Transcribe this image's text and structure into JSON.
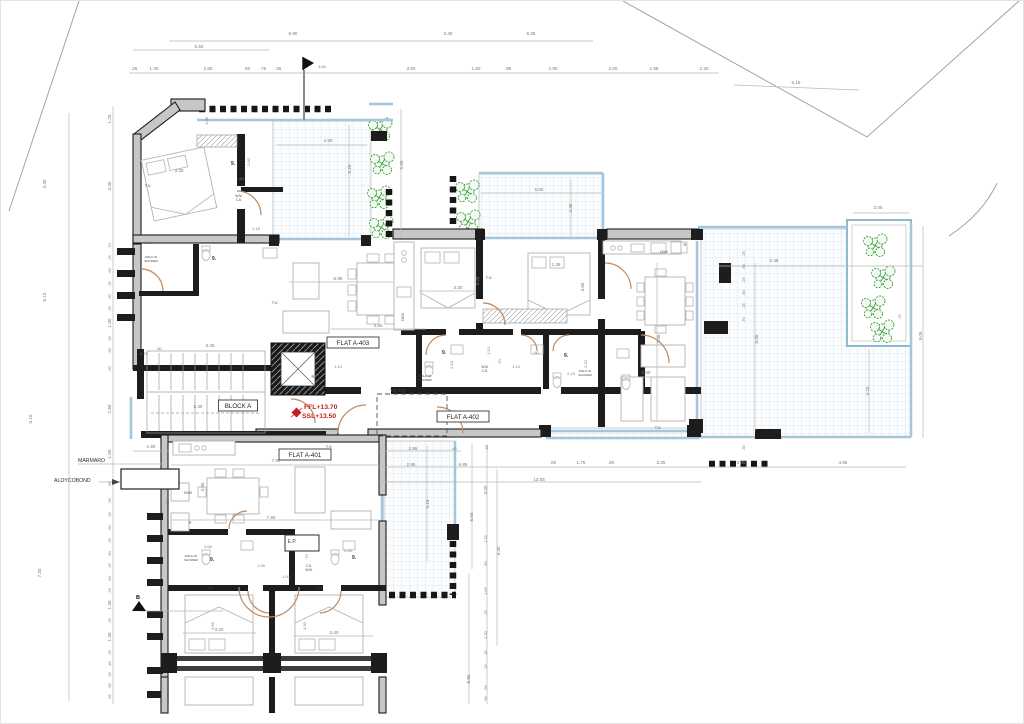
{
  "palette": {
    "wall": "#1d1d1d",
    "dim_text": "#7a7a7a",
    "label_text": "#474747",
    "red": "#c42020",
    "glass": "#a5c6dc",
    "plant": "#3d9c3d",
    "door": "#c08a5f",
    "box_stroke": "#3a3a3a"
  },
  "plan": {
    "boxed_labels": [
      {
        "text": "FLAT A-403",
        "x": 352,
        "y": 344
      },
      {
        "text": "FLAT A-402",
        "x": 462,
        "y": 418
      },
      {
        "text": "FLAT A-401",
        "x": 304,
        "y": 456
      },
      {
        "text": "BLOCK A",
        "x": 237,
        "y": 407
      }
    ],
    "red_annotations": [
      {
        "text": "FFL+13.70",
        "x": 303,
        "y": 408
      },
      {
        "text": "SSL+13.50",
        "x": 301,
        "y": 417
      }
    ],
    "material_labels": [
      {
        "text": "MARMARO",
        "x": 77,
        "y": 461
      },
      {
        "text": "ALOYCOBOND",
        "x": 53,
        "y": 481
      }
    ],
    "section_markers": [
      {
        "text": "B",
        "x": 137,
        "y": 598
      }
    ],
    "room_labels": [
      {
        "t": "9.",
        "x": 232,
        "y": 164,
        "s": 5.5
      },
      {
        "t": "9.",
        "x": 213,
        "y": 259,
        "s": 5.5
      },
      {
        "t": "9.",
        "x": 443,
        "y": 353,
        "s": 5.5
      },
      {
        "t": "9.",
        "x": 565,
        "y": 356,
        "s": 5.5
      },
      {
        "t": "9.",
        "x": 211,
        "y": 560,
        "s": 5.5
      },
      {
        "t": "9.",
        "x": 353,
        "y": 558,
        "s": 5.5
      },
      {
        "t": "T.V.",
        "x": 147,
        "y": 186,
        "s": 4
      },
      {
        "t": "T.V.",
        "x": 274,
        "y": 303,
        "s": 4
      },
      {
        "t": "T.V.",
        "x": 488,
        "y": 278,
        "s": 4
      },
      {
        "t": "T.V.",
        "x": 328,
        "y": 447,
        "s": 4
      },
      {
        "t": "T.V.",
        "x": 210,
        "y": 588,
        "s": 4
      },
      {
        "t": "T.V.",
        "x": 318,
        "y": 588,
        "s": 4
      },
      {
        "t": "T.V.",
        "x": 657,
        "y": 428,
        "s": 4
      },
      {
        "t": "D/W",
        "x": 663,
        "y": 252,
        "s": 4
      },
      {
        "t": "D/W",
        "x": 187,
        "y": 493,
        "s": 4
      },
      {
        "t": "D/W",
        "x": 403,
        "y": 316,
        "s": 4,
        "r": 1
      },
      {
        "t": "R",
        "x": 684,
        "y": 245,
        "s": 4
      },
      {
        "t": "R",
        "x": 189,
        "y": 523,
        "s": 4
      },
      {
        "t": "R",
        "x": 312,
        "y": 377,
        "s": 4
      },
      {
        "t": "E.P.",
        "x": 291,
        "y": 542,
        "s": 5
      },
      {
        "t": "T.E.P.R.",
        "x": 397,
        "y": 391,
        "s": 4.5
      },
      {
        "t": "W.M.",
        "x": 238,
        "y": 196,
        "s": 3.2
      },
      {
        "t": "C.D.",
        "x": 238,
        "y": 200,
        "s": 3.2
      },
      {
        "t": "W.M.",
        "x": 484,
        "y": 367,
        "s": 3.2
      },
      {
        "t": "C.D.",
        "x": 484,
        "y": 371,
        "s": 3.2
      },
      {
        "t": "C.D.",
        "x": 308,
        "y": 566,
        "s": 3.2
      },
      {
        "t": "W.M.",
        "x": 308,
        "y": 570,
        "s": 3.2
      },
      {
        "t": "WALK-IN",
        "x": 150,
        "y": 257,
        "s": 3
      },
      {
        "t": "SHOWER",
        "x": 150,
        "y": 261,
        "s": 3
      },
      {
        "t": "WALK-IN",
        "x": 424,
        "y": 376,
        "s": 3
      },
      {
        "t": "SHOWER",
        "x": 424,
        "y": 380,
        "s": 3
      },
      {
        "t": "WALK-IN",
        "x": 584,
        "y": 371,
        "s": 3
      },
      {
        "t": "SHOWER",
        "x": 584,
        "y": 375,
        "s": 3
      },
      {
        "t": "WALK-IN",
        "x": 190,
        "y": 556,
        "s": 3
      },
      {
        "t": "SHOWER",
        "x": 190,
        "y": 560,
        "s": 3
      }
    ],
    "dim_texts": [
      {
        "t": "8.90",
        "x": 292,
        "y": 34
      },
      {
        "t": "2.40",
        "x": 447,
        "y": 34
      },
      {
        "t": "6.35",
        "x": 530,
        "y": 34
      },
      {
        "t": "5.50",
        "x": 198,
        "y": 47
      },
      {
        "t": ".25",
        "x": 133,
        "y": 69
      },
      {
        "t": "1.25",
        "x": 153,
        "y": 69
      },
      {
        "t": "2.65",
        "x": 207,
        "y": 69
      },
      {
        "t": ".60",
        "x": 246,
        "y": 69
      },
      {
        "t": ".75",
        "x": 262,
        "y": 69
      },
      {
        "t": ".35",
        "x": 277,
        "y": 69
      },
      {
        "t": "3.60",
        "x": 321,
        "y": 67,
        "s": 4
      },
      {
        "t": "3.80",
        "x": 410,
        "y": 69
      },
      {
        "t": "1.60",
        "x": 475,
        "y": 69
      },
      {
        "t": ".95",
        "x": 507,
        "y": 69
      },
      {
        "t": "2.90",
        "x": 552,
        "y": 69
      },
      {
        "t": "2.00",
        "x": 612,
        "y": 69
      },
      {
        "t": "1.69",
        "x": 653,
        "y": 69
      },
      {
        "t": "2.20",
        "x": 703,
        "y": 69
      },
      {
        "t": "5.15",
        "x": 795,
        "y": 83
      },
      {
        "t": "4.40",
        "x": 45,
        "y": 183,
        "r": 1
      },
      {
        "t": "5.10",
        "x": 45,
        "y": 296,
        "r": 1
      },
      {
        "t": "5.10",
        "x": 31,
        "y": 418,
        "r": 1
      },
      {
        "t": "7.30",
        "x": 40,
        "y": 572,
        "r": 1
      },
      {
        "t": "1.25",
        "x": 110,
        "y": 118,
        "r": 1
      },
      {
        "t": "4.40",
        "x": 110,
        "y": 185,
        "r": 1
      },
      {
        "t": ".70",
        "x": 110,
        "y": 245,
        "r": 1,
        "s": 4
      },
      {
        "t": ".25",
        "x": 110,
        "y": 257,
        "r": 1,
        "s": 4
      },
      {
        "t": ".60",
        "x": 110,
        "y": 270,
        "r": 1,
        "s": 4
      },
      {
        "t": ".25",
        "x": 110,
        "y": 283,
        "r": 1,
        "s": 4
      },
      {
        "t": ".60",
        "x": 110,
        "y": 296,
        "r": 1,
        "s": 4
      },
      {
        "t": ".25",
        "x": 110,
        "y": 308,
        "r": 1,
        "s": 4
      },
      {
        "t": "1.30",
        "x": 110,
        "y": 322,
        "r": 1
      },
      {
        "t": ".25",
        "x": 110,
        "y": 338,
        "r": 1,
        "s": 4
      },
      {
        "t": ".90",
        "x": 110,
        "y": 350,
        "r": 1,
        "s": 4
      },
      {
        "t": ".50",
        "x": 110,
        "y": 368,
        "r": 1,
        "s": 4
      },
      {
        "t": "2.60",
        "x": 110,
        "y": 408,
        "r": 1
      },
      {
        "t": "1.50",
        "x": 110,
        "y": 453,
        "r": 1
      },
      {
        "t": ".50",
        "x": 110,
        "y": 483,
        "r": 1,
        "s": 4
      },
      {
        "t": ".95",
        "x": 110,
        "y": 500,
        "r": 1,
        "s": 4
      },
      {
        "t": ".25",
        "x": 110,
        "y": 514,
        "r": 1,
        "s": 4
      },
      {
        "t": ".60",
        "x": 110,
        "y": 527,
        "r": 1,
        "s": 4
      },
      {
        "t": ".25",
        "x": 110,
        "y": 540,
        "r": 1,
        "s": 4
      },
      {
        "t": ".60",
        "x": 110,
        "y": 553,
        "r": 1,
        "s": 4
      },
      {
        "t": ".25",
        "x": 110,
        "y": 565,
        "r": 1,
        "s": 4
      },
      {
        "t": ".60",
        "x": 110,
        "y": 578,
        "r": 1,
        "s": 4
      },
      {
        "t": ".25",
        "x": 110,
        "y": 590,
        "r": 1,
        "s": 4
      },
      {
        "t": "1.30",
        "x": 110,
        "y": 604,
        "r": 1
      },
      {
        "t": ".25",
        "x": 110,
        "y": 620,
        "r": 1,
        "s": 4
      },
      {
        "t": "1.30",
        "x": 110,
        "y": 636,
        "r": 1
      },
      {
        "t": ".25",
        "x": 110,
        "y": 652,
        "r": 1,
        "s": 4
      },
      {
        "t": ".45",
        "x": 110,
        "y": 663,
        "r": 1,
        "s": 4
      },
      {
        "t": ".25",
        "x": 110,
        "y": 674,
        "r": 1,
        "s": 4
      },
      {
        "t": ".55",
        "x": 110,
        "y": 685,
        "r": 1,
        "s": 4
      },
      {
        "t": ".55",
        "x": 110,
        "y": 696,
        "r": 1,
        "s": 4
      },
      {
        "t": "2.05",
        "x": 877,
        "y": 208
      },
      {
        "t": "9.05",
        "x": 921,
        "y": 335,
        "r": 1
      },
      {
        "t": "6.35",
        "x": 773,
        "y": 261
      },
      {
        "t": "8.05",
        "x": 757,
        "y": 338,
        "r": 1
      },
      {
        "t": ".75",
        "x": 900,
        "y": 316,
        "r": 1,
        "s": 4
      },
      {
        "t": "4.25",
        "x": 868,
        "y": 390,
        "r": 1
      },
      {
        "t": ".35",
        "x": 744,
        "y": 447,
        "r": 1,
        "s": 4
      },
      {
        "t": ".25",
        "x": 744,
        "y": 253,
        "r": 1,
        "s": 4
      },
      {
        "t": ".60",
        "x": 744,
        "y": 266,
        "r": 1,
        "s": 4
      },
      {
        "t": ".25",
        "x": 744,
        "y": 279,
        "r": 1,
        "s": 4
      },
      {
        "t": ".60",
        "x": 744,
        "y": 292,
        "r": 1,
        "s": 4
      },
      {
        "t": ".25",
        "x": 744,
        "y": 305,
        "r": 1,
        "s": 4
      },
      {
        "t": ".70",
        "x": 744,
        "y": 319,
        "r": 1,
        "s": 4
      },
      {
        "t": "2.95",
        "x": 412,
        "y": 449
      },
      {
        "t": ".40",
        "x": 453,
        "y": 449,
        "s": 4
      },
      {
        "t": ".45",
        "x": 487,
        "y": 447,
        "r": 1,
        "s": 4
      },
      {
        "t": "2.95",
        "x": 410,
        "y": 465
      },
      {
        "t": "6.85",
        "x": 462,
        "y": 465
      },
      {
        "t": ".60",
        "x": 552,
        "y": 463
      },
      {
        "t": "1.75",
        "x": 580,
        "y": 463
      },
      {
        "t": ".60",
        "x": 610,
        "y": 463
      },
      {
        "t": "3.25",
        "x": 660,
        "y": 463
      },
      {
        "t": "3.45",
        "x": 740,
        "y": 463
      },
      {
        "t": "4.95",
        "x": 842,
        "y": 463
      },
      {
        "t": "13.05",
        "x": 538,
        "y": 480
      },
      {
        "t": "5.10",
        "x": 428,
        "y": 503,
        "r": 1
      },
      {
        "t": "6.50",
        "x": 472,
        "y": 516,
        "r": 1
      },
      {
        "t": "3.00",
        "x": 486,
        "y": 489,
        "r": 1
      },
      {
        "t": "9.30",
        "x": 499,
        "y": 550,
        "r": 1
      },
      {
        "t": "1.35",
        "x": 486,
        "y": 538,
        "r": 1,
        "s": 4
      },
      {
        "t": ".60",
        "x": 486,
        "y": 563,
        "r": 1,
        "s": 4
      },
      {
        "t": "1.65",
        "x": 486,
        "y": 590,
        "r": 1,
        "s": 4
      },
      {
        "t": ".25",
        "x": 486,
        "y": 612,
        "r": 1,
        "s": 4
      },
      {
        "t": "1.30",
        "x": 486,
        "y": 634,
        "r": 1,
        "s": 4
      },
      {
        "t": ".45",
        "x": 486,
        "y": 652,
        "r": 1,
        "s": 4
      },
      {
        "t": ".25",
        "x": 486,
        "y": 666,
        "r": 1,
        "s": 4
      },
      {
        "t": "6.80",
        "x": 469,
        "y": 678,
        "r": 1
      },
      {
        "t": ".55",
        "x": 486,
        "y": 687,
        "r": 1,
        "s": 4
      },
      {
        "t": ".55",
        "x": 486,
        "y": 698,
        "r": 1,
        "s": 4
      },
      {
        "t": "1.00",
        "x": 207,
        "y": 120,
        "r": 1,
        "s": 4
      },
      {
        "t": "3.30",
        "x": 178,
        "y": 171
      },
      {
        "t": "1.30",
        "x": 148,
        "y": 243,
        "s": 4
      },
      {
        "t": "2.00",
        "x": 249,
        "y": 161,
        "r": 1,
        "s": 4
      },
      {
        "t": ".80",
        "x": 240,
        "y": 179,
        "s": 4
      },
      {
        "t": "1.15",
        "x": 255,
        "y": 229,
        "s": 4
      },
      {
        "t": "4.90",
        "x": 327,
        "y": 141
      },
      {
        "t": "5.25",
        "x": 350,
        "y": 168,
        "r": 1
      },
      {
        "t": "5.50",
        "x": 402,
        "y": 164,
        "r": 1
      },
      {
        "t": "5.00",
        "x": 538,
        "y": 190
      },
      {
        "t": "2.40",
        "x": 571,
        "y": 207,
        "r": 1
      },
      {
        "t": "5.95",
        "x": 337,
        "y": 279
      },
      {
        "t": "3.50",
        "x": 377,
        "y": 326
      },
      {
        "t": "3.30",
        "x": 457,
        "y": 288
      },
      {
        "t": "3.20",
        "x": 478,
        "y": 280,
        "r": 1
      },
      {
        "t": "1.35",
        "x": 555,
        "y": 265
      },
      {
        "t": "3.60",
        "x": 583,
        "y": 286,
        "r": 1
      },
      {
        "t": "7.85",
        "x": 659,
        "y": 338,
        "r": 1
      },
      {
        "t": "3.60",
        "x": 645,
        "y": 373
      },
      {
        "t": "1.10",
        "x": 337,
        "y": 367,
        "s": 4
      },
      {
        "t": "1.10",
        "x": 489,
        "y": 350,
        "r": 1,
        "s": 4
      },
      {
        "t": "2.10",
        "x": 452,
        "y": 364,
        "r": 1,
        "s": 4
      },
      {
        "t": ".60",
        "x": 535,
        "y": 353,
        "s": 4
      },
      {
        "t": ".70",
        "x": 500,
        "y": 361,
        "r": 1,
        "s": 4
      },
      {
        "t": "1.10",
        "x": 515,
        "y": 367,
        "s": 4
      },
      {
        "t": "2.15",
        "x": 570,
        "y": 374,
        "s": 4
      },
      {
        "t": "2.20",
        "x": 586,
        "y": 363,
        "r": 1,
        "s": 4
      },
      {
        "t": "1.75",
        "x": 143,
        "y": 354,
        "s": 4
      },
      {
        "t": ".50",
        "x": 158,
        "y": 349,
        "s": 4
      },
      {
        "t": "3.25",
        "x": 209,
        "y": 346
      },
      {
        "t": "5.30",
        "x": 197,
        "y": 407
      },
      {
        "t": "1.90",
        "x": 150,
        "y": 447
      },
      {
        "t": "7.90",
        "x": 275,
        "y": 461
      },
      {
        "t": "7.90",
        "x": 270,
        "y": 518
      },
      {
        "t": "3.80",
        "x": 203,
        "y": 486,
        "r": 1
      },
      {
        "t": "2.65",
        "x": 207,
        "y": 547,
        "s": 4
      },
      {
        "t": "1.05",
        "x": 260,
        "y": 566,
        "s": 4
      },
      {
        "t": "1.00",
        "x": 285,
        "y": 577,
        "s": 4
      },
      {
        "t": ".70",
        "x": 307,
        "y": 556,
        "r": 1,
        "s": 4
      },
      {
        "t": "2.20",
        "x": 347,
        "y": 551,
        "s": 4
      },
      {
        "t": ".50",
        "x": 168,
        "y": 501,
        "r": 1,
        "s": 4
      },
      {
        "t": "3.20",
        "x": 218,
        "y": 630
      },
      {
        "t": "3.40",
        "x": 333,
        "y": 633
      },
      {
        "t": "3.50",
        "x": 213,
        "y": 625,
        "r": 1,
        "s": 4
      },
      {
        "t": "3.30",
        "x": 305,
        "y": 625,
        "r": 1,
        "s": 4
      }
    ]
  }
}
